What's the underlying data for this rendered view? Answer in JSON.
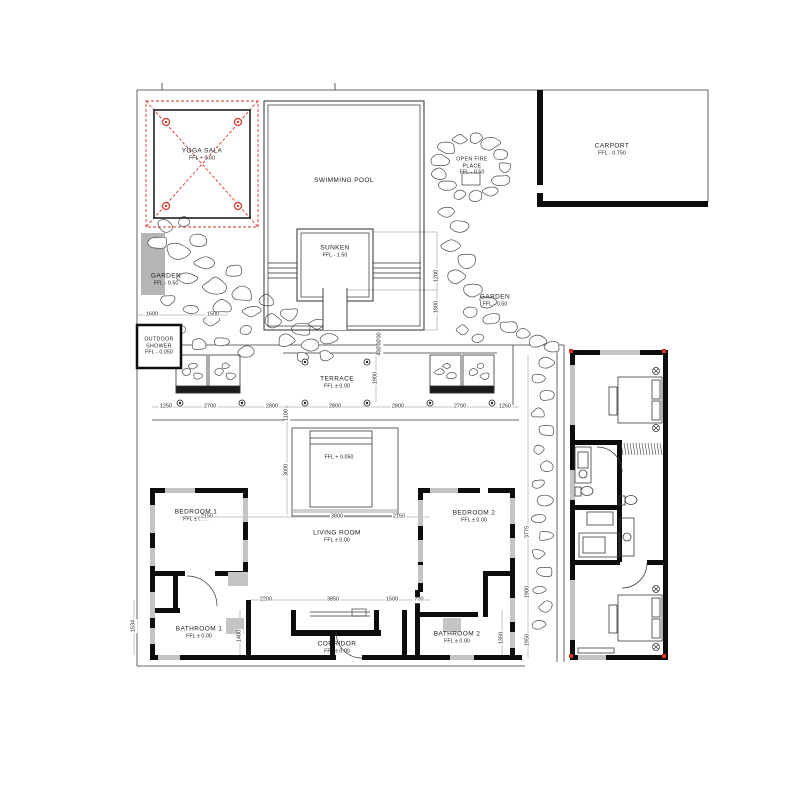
{
  "labels": {
    "yoga_sala": {
      "name": "YOGA SALA",
      "ffl": "FFL + 0.60"
    },
    "swimming_pool": {
      "name": "SWIMMING POOL"
    },
    "sunken": {
      "name": "SUNKEN",
      "ffl": "FFL - 1.50"
    },
    "garden_left": {
      "name": "GARDEN",
      "ffl": "FFL - 0.50"
    },
    "garden_right": {
      "name": "GARDEN",
      "ffl": "FFL - 0.50"
    },
    "open_fire_place": {
      "line1": "OPEN FIRE",
      "line2": "PLACE",
      "ffl": "FFL - 0.50"
    },
    "carport": {
      "name": "CARPORT",
      "ffl": "FFL - 0.750"
    },
    "outdoor_shower": {
      "line1": "OUTDOOR",
      "line2": "SHOWER",
      "ffl": "FFL - 0.050"
    },
    "terrace": {
      "name": "TERRACE",
      "ffl": "FFL ± 0.00"
    },
    "pond": {
      "ffl": "FFL + 0.050"
    },
    "living_room": {
      "name": "LIVING ROOM",
      "ffl": "FFL ± 0.00"
    },
    "bedroom1": {
      "name": "BEDROOM 1",
      "ffl": "FFL ± 0.00"
    },
    "bedroom2": {
      "name": "BEDROOM 2",
      "ffl": "FFL ± 0.00"
    },
    "bathroom1": {
      "name": "BATHROOM 1",
      "ffl": "FFL ± 0.00"
    },
    "bathroom2": {
      "name": "BATHROOM 2",
      "ffl": "FFL ± 0.00"
    },
    "corridor": {
      "name": "CORRIDOR",
      "ffl": "FFL ± 0.00"
    }
  },
  "dimensions": [
    {
      "t": "1250",
      "x": 166,
      "y": 407
    },
    {
      "t": "2700",
      "x": 210,
      "y": 407
    },
    {
      "t": "2800",
      "x": 272,
      "y": 407
    },
    {
      "t": "2800",
      "x": 335,
      "y": 407
    },
    {
      "t": "2800",
      "x": 398,
      "y": 407
    },
    {
      "t": "2700",
      "x": 460,
      "y": 407
    },
    {
      "t": "1250",
      "x": 505,
      "y": 407
    },
    {
      "t": "2150",
      "x": 207,
      "y": 517
    },
    {
      "t": "3800",
      "x": 337,
      "y": 517
    },
    {
      "t": "2150",
      "x": 399,
      "y": 517
    },
    {
      "t": "2200",
      "x": 266,
      "y": 600
    },
    {
      "t": "3850",
      "x": 333,
      "y": 600
    },
    {
      "t": "1500",
      "x": 392,
      "y": 600
    },
    {
      "t": "700",
      "x": 419,
      "y": 600
    },
    {
      "t": "1600",
      "x": 152,
      "y": 315
    },
    {
      "t": "1500",
      "x": 213,
      "y": 315
    },
    {
      "t": "1100",
      "x": 287,
      "y": 415,
      "v": true
    },
    {
      "t": "3000",
      "x": 287,
      "y": 470,
      "v": true
    },
    {
      "t": "1400",
      "x": 240,
      "y": 636,
      "v": true
    },
    {
      "t": "1350",
      "x": 502,
      "y": 638,
      "v": true
    },
    {
      "t": "1534",
      "x": 134,
      "y": 626,
      "v": true
    },
    {
      "t": "3775",
      "x": 528,
      "y": 532,
      "v": true
    },
    {
      "t": "1900",
      "x": 528,
      "y": 592,
      "v": true
    },
    {
      "t": "1950",
      "x": 528,
      "y": 640,
      "v": true
    },
    {
      "t": "1200",
      "x": 437,
      "y": 276,
      "v": true
    },
    {
      "t": "1800",
      "x": 437,
      "y": 307,
      "v": true
    },
    {
      "t": "400",
      "x": 380,
      "y": 337,
      "v": true
    },
    {
      "t": "400",
      "x": 380,
      "y": 344,
      "v": true
    },
    {
      "t": "400",
      "x": 380,
      "y": 351,
      "v": true
    },
    {
      "t": "1900",
      "x": 376,
      "y": 378,
      "v": true
    }
  ],
  "colors": {
    "red": "#d9342b",
    "wall": "#0d0d0d",
    "window": "#c4c4c4",
    "grey_fill": "#b5b5b5"
  }
}
